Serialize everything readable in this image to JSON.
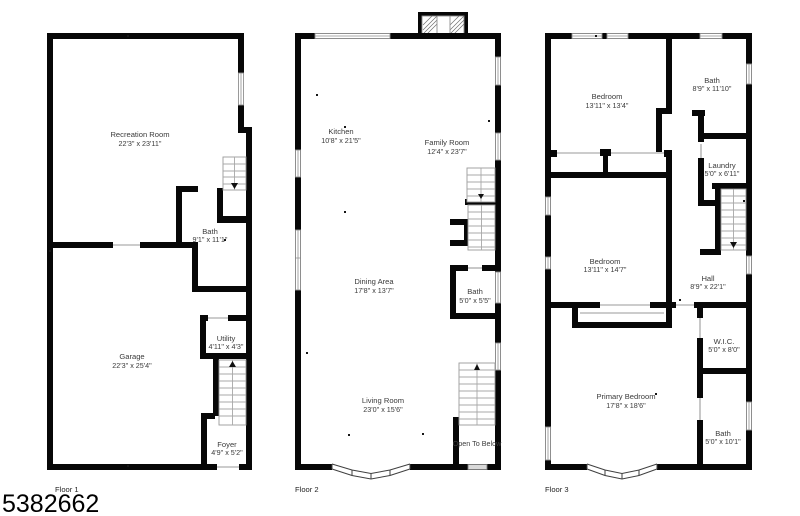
{
  "listing_number": "5382662",
  "floors": [
    {
      "caption": "Floor 1",
      "rooms": [
        {
          "name": "Recreation Room",
          "dims": "22'3\" x 23'11\""
        },
        {
          "name": "Bath",
          "dims": "9'1\" x 11'1\""
        },
        {
          "name": "Garage",
          "dims": "22'3\" x 25'4\""
        },
        {
          "name": "Utility",
          "dims": "4'11\" x 4'3\""
        },
        {
          "name": "Foyer",
          "dims": "4'9\" x 5'2\""
        }
      ]
    },
    {
      "caption": "Floor 2",
      "rooms": [
        {
          "name": "Kitchen",
          "dims": "10'8\" x 21'5\""
        },
        {
          "name": "Family Room",
          "dims": "12'4\" x 23'7\""
        },
        {
          "name": "Dining Area",
          "dims": "17'8\" x 13'7\""
        },
        {
          "name": "Bath",
          "dims": "5'0\" x 5'5\""
        },
        {
          "name": "Living Room",
          "dims": "23'0\" x 15'6\""
        }
      ],
      "note": "Open To Below"
    },
    {
      "caption": "Floor 3",
      "rooms": [
        {
          "name": "Bedroom",
          "dims": "13'11\" x 13'4\""
        },
        {
          "name": "Bath",
          "dims": "8'9\" x 11'10\""
        },
        {
          "name": "Laundry",
          "dims": "5'0\" x 6'11\""
        },
        {
          "name": "Bedroom",
          "dims": "13'11\" x 14'7\""
        },
        {
          "name": "Hall",
          "dims": "8'9\" x 22'1\""
        },
        {
          "name": "W.I.C.",
          "dims": "5'0\" x 8'0\""
        },
        {
          "name": "Primary Bedroom",
          "dims": "17'8\" x 18'6\""
        },
        {
          "name": "Bath",
          "dims": "5'0\" x 10'1\""
        }
      ]
    }
  ],
  "colors": {
    "wall": "#000000",
    "background": "#ffffff",
    "stair_lines": "#9a9a9a",
    "window_outline": "#8f8f8f",
    "label_text": "#3b3b3b"
  }
}
